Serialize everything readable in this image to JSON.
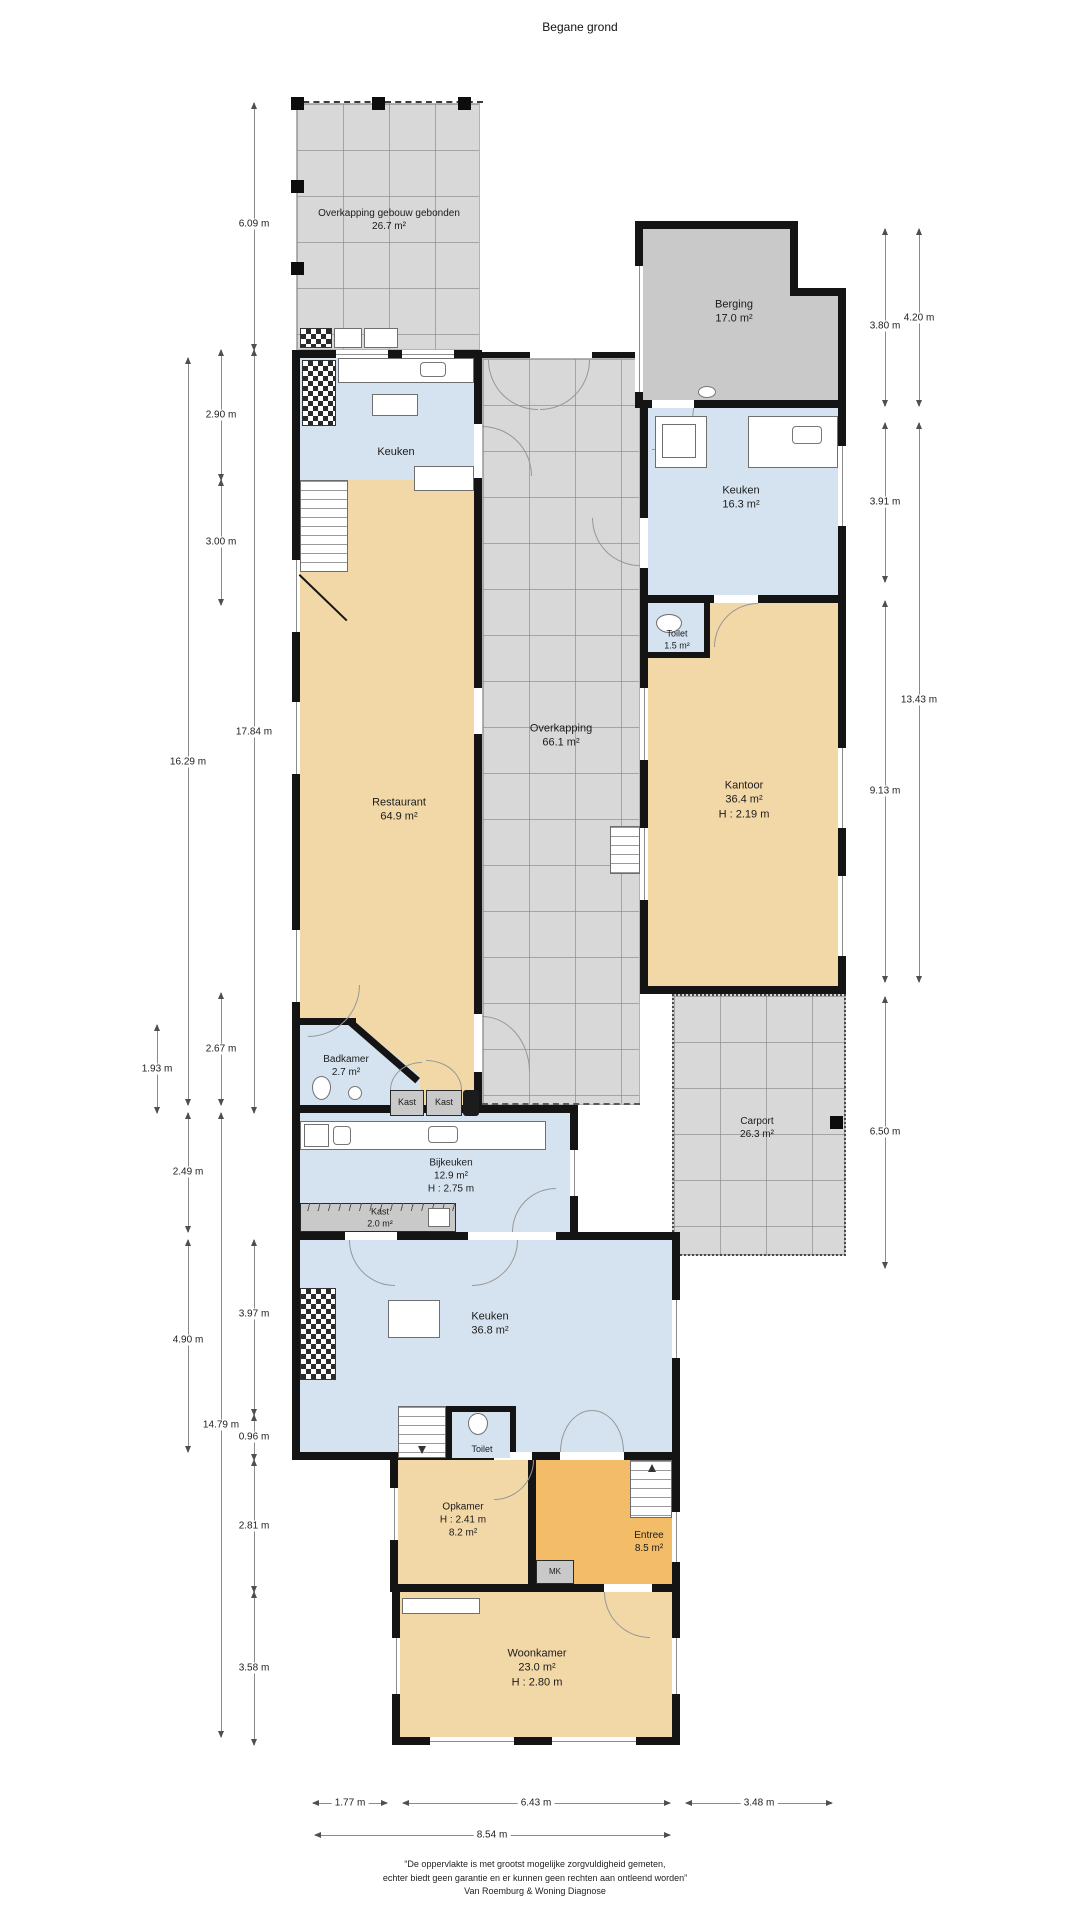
{
  "title": "Begane grond",
  "rooms": {
    "overkapping_top": {
      "line1": "Overkapping gebouw gebonden",
      "line2": "26.7 m²"
    },
    "berging": {
      "line1": "Berging",
      "line2": "17.0 m²"
    },
    "keuken_links": {
      "line1": "Keuken"
    },
    "restaurant": {
      "line1": "Restaurant",
      "line2": "64.9 m²"
    },
    "overkapping": {
      "line1": "Overkapping",
      "line2": "66.1 m²"
    },
    "keuken_rechts": {
      "line1": "Keuken",
      "line2": "16.3 m²"
    },
    "toilet_rechts": {
      "line1": "Toilet",
      "line2": "1.5 m²"
    },
    "kantoor": {
      "line1": "Kantoor",
      "line2": "36.4 m²",
      "line3": "H : 2.19 m"
    },
    "carport": {
      "line1": "Carport",
      "line2": "26.3 m²"
    },
    "badkamer": {
      "line1": "Badkamer",
      "line2": "2.7 m²"
    },
    "kast1": {
      "line1": "Kast"
    },
    "kast2": {
      "line1": "Kast"
    },
    "bijkeuken": {
      "line1": "Bijkeuken",
      "line2": "12.9 m²",
      "line3": "H : 2.75 m"
    },
    "kast3": {
      "line1": "Kast",
      "line2": "2.0 m²"
    },
    "keuken_midden": {
      "line1": "Keuken",
      "line2": "36.8 m²"
    },
    "toilet_midden": {
      "line1": "Toilet"
    },
    "opkamer": {
      "line1": "Opkamer",
      "line2": "H : 2.41 m",
      "line3": "8.2 m²"
    },
    "entree": {
      "line1": "Entree",
      "line2": "8.5 m²"
    },
    "mk": {
      "line1": "MK"
    },
    "woonkamer": {
      "line1": "Woonkamer",
      "line2": "23.0 m²",
      "line3": "H : 2.80 m"
    }
  },
  "dims": {
    "v6_09": "6.09 m",
    "v17_84": "17.84 m",
    "v3_97": "3.97 m",
    "v0_96": "0.96 m",
    "v2_81": "2.81 m",
    "v3_58": "3.58 m",
    "v2_90": "2.90 m",
    "v3_00": "3.00 m",
    "v2_67": "2.67 m",
    "v14_79": "14.79 m",
    "v16_29": "16.29 m",
    "v2_49": "2.49 m",
    "v4_90": "4.90 m",
    "v1_93": "1.93 m",
    "r3_80": "3.80 m",
    "r4_20": "4.20 m",
    "r3_91": "3.91 m",
    "r13_43": "13.43 m",
    "r9_13": "9.13 m",
    "r6_50": "6.50 m",
    "b1_77": "1.77 m",
    "b6_43": "6.43 m",
    "b3_48": "3.48 m",
    "b8_54": "8.54 m"
  },
  "footer": {
    "line1": "“De oppervlakte is met grootst mogelijke zorgvuldigheid gemeten,",
    "line2": "echter biedt geen garantie en er kunnen geen rechten aan ontleend worden”",
    "line3": "Van Roemburg & Woning Diagnose"
  },
  "colors": {
    "room_tan": "#f2d8a7",
    "room_blue": "#d5e3f0",
    "room_orange": "#f2bc68",
    "zone_grey": "#d8d8d8",
    "berging_grey": "#c9c9c9",
    "wall": "#141414"
  }
}
